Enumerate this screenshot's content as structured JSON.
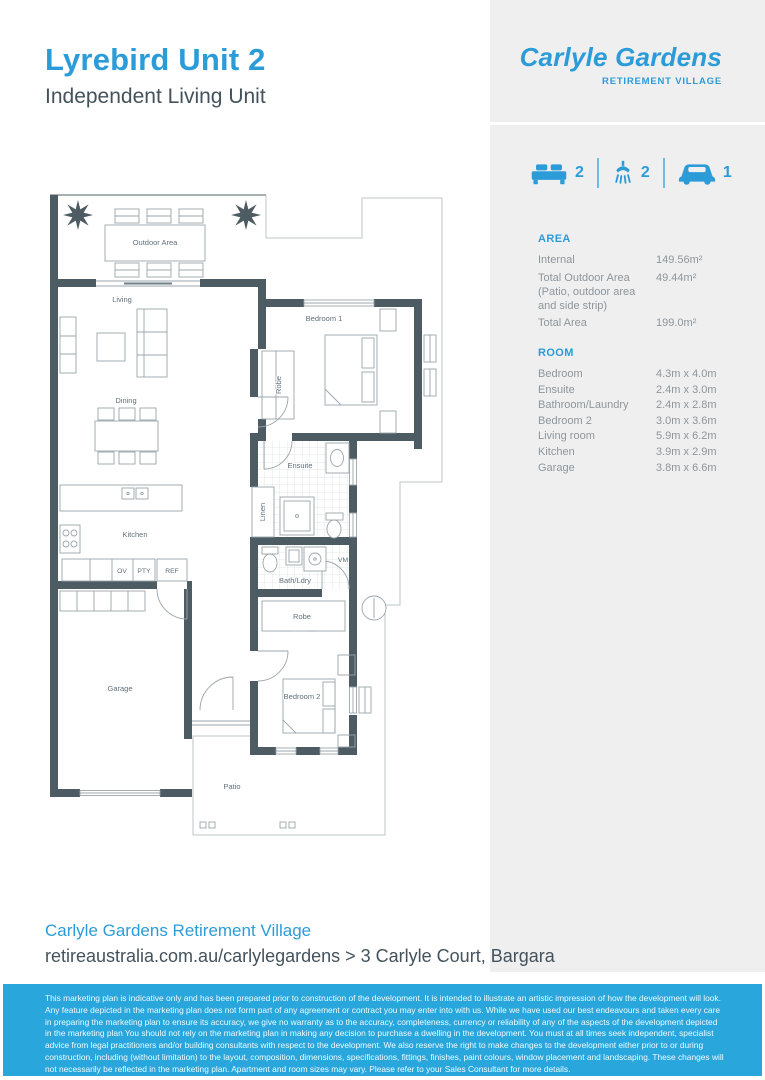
{
  "page": {
    "title": "Lyrebird Unit 2",
    "subtitle": "Independent Living Unit"
  },
  "logo": {
    "name": "Carlyle Gardens",
    "tagline": "RETIREMENT VILLAGE"
  },
  "colors": {
    "accent": "#2b9cd8",
    "disclaimer_bg": "#29a6dc",
    "wall": "#4d5c63",
    "sidebar_bg": "#efeff0"
  },
  "stats": {
    "beds": "2",
    "baths": "2",
    "cars": "1"
  },
  "area": {
    "heading": "AREA",
    "rows": [
      {
        "label": "Internal",
        "value": "149.56m²"
      },
      {
        "label": "Total Outdoor Area (Patio, outdoor area and side strip)",
        "value": "49.44m²"
      },
      {
        "label": "Total Area",
        "value": "199.0m²"
      }
    ]
  },
  "room": {
    "heading": "ROOM",
    "rows": [
      {
        "label": "Bedroom",
        "value": "4.3m x 4.0m"
      },
      {
        "label": "Ensuite",
        "value": "2.4m x 3.0m"
      },
      {
        "label": "Bathroom/Laundry",
        "value": "2.4m x 2.8m"
      },
      {
        "label": "Bedroom 2",
        "value": "3.0m x 3.6m"
      },
      {
        "label": "Living room",
        "value": "5.9m x 6.2m"
      },
      {
        "label": "Kitchen",
        "value": "3.9m x 2.9m"
      },
      {
        "label": "Garage",
        "value": "3.8m x 6.6m"
      }
    ]
  },
  "plan": {
    "labels": {
      "outdoor_area": "Outdoor Area",
      "living": "Living",
      "dining": "Dining",
      "kitchen": "Kitchen",
      "oven": "OV",
      "pantry": "PTY",
      "fridge": "REF",
      "robe_1": "Robe",
      "bedroom_1": "Bedroom 1",
      "ensuite": "Ensuite",
      "linen": "Linen",
      "bath_laundry": "Bath/Ldry",
      "washing_machine": "VM",
      "garage": "Garage",
      "robe_2": "Robe",
      "bedroom_2": "Bedroom 2",
      "patio": "Patio"
    }
  },
  "footer": {
    "org": "Carlyle Gardens Retirement Village",
    "address": "retireaustralia.com.au/carlylegardens > 3 Carlyle Court, Bargara"
  },
  "disclaimer": {
    "text": "This marketing plan is indicative only and has been prepared prior to construction of the development. It is intended to illustrate an artistic impression of how the development will look. Any feature depicted in the marketing plan does not form part of any agreement or contract you may enter into with us. While we have used our best endeavours and taken every care in preparing the marketing plan to ensure its accuracy, we give no warranty as to the accuracy, completeness, currency or reliability of any of the aspects of the development depicted in the marketing plan You should not rely on the marketing plan in making any decision to purchase a dwelling in the development. You must at all times seek independent, specialist advice from legal practitioners and/or building consultants with respect to the development. We also reserve the right to make changes to the development either prior to or during construction, including (without limitation) to the layout, composition, dimensions, specifications, fittings, finishes, paint colours, window placement and landscaping. These changes will not necessarily be reflected in the marketing plan. Apartment and room sizes may vary. Please refer to your Sales Consultant for more details."
  }
}
